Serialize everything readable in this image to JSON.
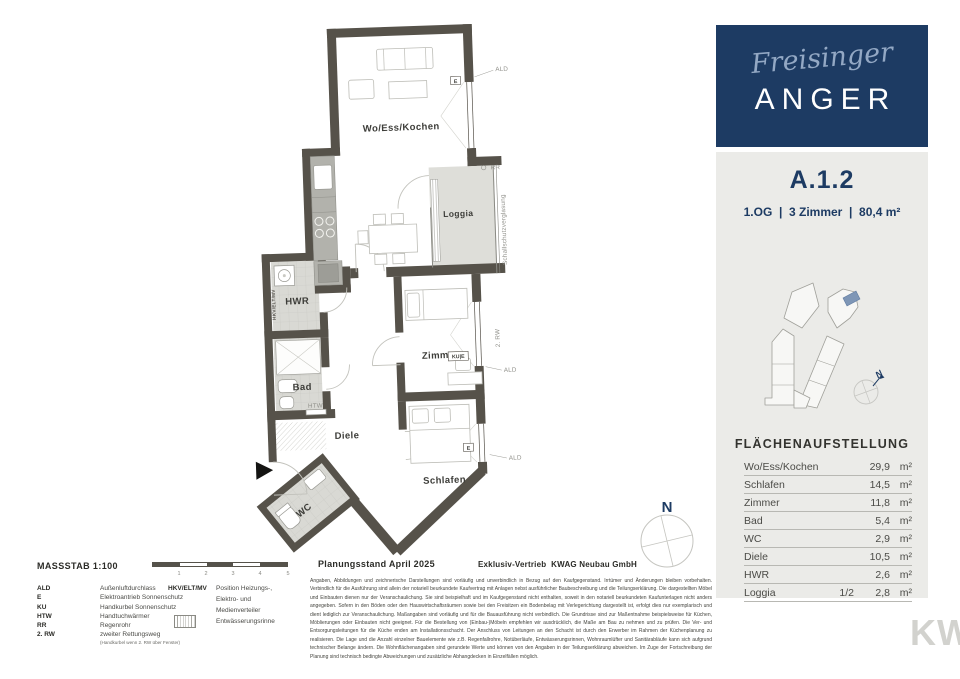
{
  "brand": {
    "script": "Freisinger",
    "name": "ANGER"
  },
  "unit": {
    "id": "A.1.2",
    "details": "1.OG  |  3 Zimmer  |  80,4 m²"
  },
  "keyplan": {
    "compass": "N"
  },
  "area_table": {
    "title": "FLÄCHENAUFSTELLUNG",
    "rows": [
      {
        "label": "Wo/Ess/Kochen",
        "factor": "",
        "value": "29,9",
        "unit": "m²"
      },
      {
        "label": "Schlafen",
        "factor": "",
        "value": "14,5",
        "unit": "m²"
      },
      {
        "label": "Zimmer",
        "factor": "",
        "value": "11,8",
        "unit": "m²"
      },
      {
        "label": "Bad",
        "factor": "",
        "value": "5,4",
        "unit": "m²"
      },
      {
        "label": "WC",
        "factor": "",
        "value": "2,9",
        "unit": "m²"
      },
      {
        "label": "Diele",
        "factor": "",
        "value": "10,5",
        "unit": "m²"
      },
      {
        "label": "HWR",
        "factor": "",
        "value": "2,6",
        "unit": "m²"
      },
      {
        "label": "Loggia",
        "factor": "1/2",
        "value": "2,8",
        "unit": "m²"
      }
    ]
  },
  "plan": {
    "rooms": {
      "living": "Wo/Ess/Kochen",
      "loggia": "Loggia",
      "hwr": "HWR",
      "bad": "Bad",
      "diele": "Diele",
      "zimmer": "Zimmer",
      "schlafen": "Schlafen",
      "wc": "WC"
    },
    "annotations": {
      "ald": "ALD",
      "e": "E",
      "kue": "KU|E",
      "rr": "RR",
      "rw": "2. RW",
      "htw": "HTW",
      "hkv": "HKV/ELT/MV",
      "glazing": "Schallschutzverglasung",
      "compass": "N"
    }
  },
  "footer": {
    "scale_label": "MASSSTAB 1:100",
    "scale_ticks": [
      "1",
      "2",
      "3",
      "4",
      "5"
    ],
    "status": "Planungsstand April 2025",
    "sales": "Exklusiv-Vertrieb  KWAG Neubau GmbH",
    "legend": [
      {
        "abbr": "ALD",
        "text": "Außenluftdurchlass"
      },
      {
        "abbr": "E",
        "text": "Elektroantrieb Sonnenschutz"
      },
      {
        "abbr": "KU",
        "text": "Handkurbel Sonnenschutz"
      },
      {
        "abbr": "HTW",
        "text": "Handtuchwärmer"
      },
      {
        "abbr": "RR",
        "text": "Regenrohr"
      },
      {
        "abbr": "2. RW",
        "text": "zweiter Rettungsweg"
      }
    ],
    "legend_note": "(Handkurbel wenn 2. RW über Fenster)",
    "legend2": {
      "abbr": "HKV/ELT/MV",
      "text": "Position Heizungs-, Elektro- und Medienverteiler",
      "symbol_text": "Entwässerungsrinne"
    },
    "disclaimer": "Angaben, Abbildungen und zeichnerische Darstellungen sind vorläufig und unverbindlich in Bezug auf den Kaufgegenstand. Irrtümer und Änderungen bleiben vorbehalten. Verbindlich für die Ausführung sind allein der notariell beurkundete Kaufvertrag mit Anlagen nebst ausführlicher Baubeschreibung und die Teilungserklärung. Die dargestellten Möbel und Einbauten dienen nur der Veranschaulichung. Sie sind beispielhaft und im Kaufgegenstand nicht enthalten, soweit in den notariell beurkundeten Kaufunterlagen nicht anders angegeben. Sofern in den Böden oder den Hauswirtschaftsräumen sowie bei den Freisitzen ein Bodenbelag mit Verlegerichtung dargestellt ist, erfolgt dies nur exemplarisch und dient lediglich zur Veranschaulichung. Maßangaben sind vorläufig und für die Bauausführung nicht verbindlich. Die Grundrisse sind zur Maßentnahme beispielsweise für Küchen, Möblierungen oder Einbauten nicht geeignet. Für die Bestellung von (Einbau-)Möbeln empfehlen wir ausdrücklich, die Maße am Bau zu nehmen und zu prüfen. Die Ver- und Entsorgungsleitungen für die Küche enden am Installationsschacht. Der Anschluss von Leitungen an den Schacht ist durch den Erwerber im Rahmen der Küchenplanung zu realisieren. Die Lage und die Anzahl einzelner Bauelemente wie z.B. Regenfallrohre, Notüberläufe, Entwässerungsrinnen, Wohnraumlüfter und Sanitärabläufe kann sich aufgrund technischer Belange ändern. Die Wohnflächenangaben sind gerundete Werte und können von den Angaben in der Teilungserklärung abweichen. Im Zuge der Fortschreibung der Planung sind technisch bedingte Abweichungen und zusätzliche Abhangdecken in Einzelfällen möglich."
  },
  "corner_logo": "KW"
}
